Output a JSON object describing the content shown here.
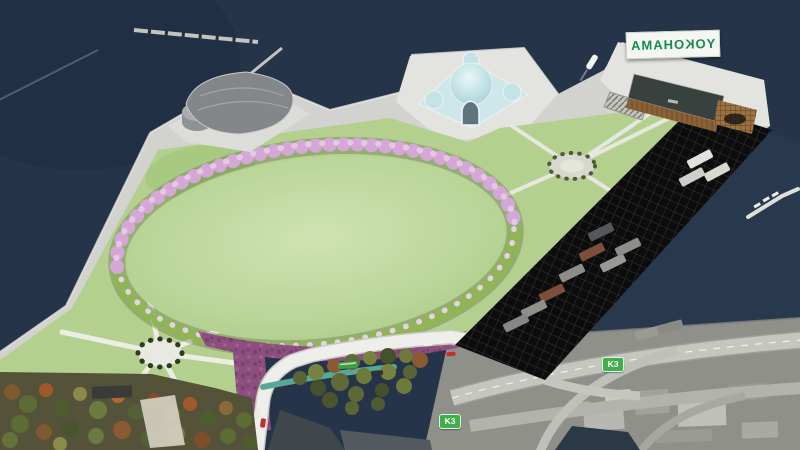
{
  "sign": {
    "text": "YOKOHAMA",
    "mirrored": true,
    "text_color": "#168a52",
    "bg_color": "#f4f6f1"
  },
  "route_shields": [
    {
      "text": "K3"
    },
    {
      "text": "K3"
    }
  ],
  "shield_style": {
    "bg_color": "#3faf4c",
    "text_color": "#ffffff"
  },
  "palette": {
    "water": "#263449",
    "quay": "#d2d3cf",
    "pad_light": "#e3e4df",
    "lawn": "#b4d08f",
    "ellipse_lawn_center": "#cbe0ab",
    "cherry_pink": "#d5a7d7",
    "ring_green": "#8fb554",
    "flower_purple": "#8c4f7e",
    "construction_black": "#0c0c0c",
    "road_white": "#eeeeea",
    "city_gray": "#90908a",
    "dome_teal": "#cde7ea",
    "wood_brown": "#8a6136",
    "glass_teal": "#2f8f96"
  }
}
